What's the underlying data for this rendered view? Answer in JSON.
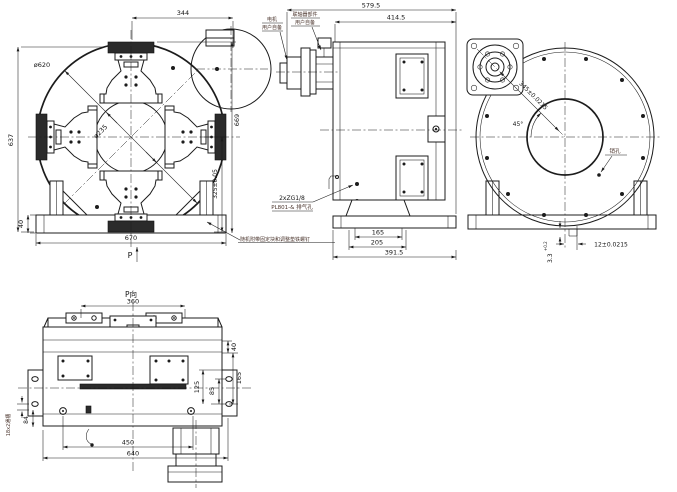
{
  "meta": {
    "background": "#ffffff",
    "line_color": "#1c1c1c",
    "annotation_color": "#4a342c"
  },
  "front": {
    "dim_motor_offset": "344",
    "dim_height": "637",
    "dia_outer": "ø620",
    "dia_inner": "ø235",
    "dim_center_height": "325±0.05",
    "dim_overall_height": "669",
    "dim_base_width": "670",
    "dim_base_height": "40",
    "view_arrow": "P",
    "note": "随机附带固定块和调整垫铁螺钉"
  },
  "side": {
    "dim_overall": "579.5",
    "dim_body": "414.5",
    "dim_base_inner": "165",
    "dim_base_mid": "205",
    "dim_base_outer": "391.5",
    "motor_label_1": "电机",
    "motor_label_2": "用户自备",
    "coupling_label_1": "联轴器部件",
    "coupling_label_2": "用户自备",
    "port_label_1": "2xZG1/8",
    "port_label_2": "PL801-& 排气孔"
  },
  "rear": {
    "dim_diagonal": "345±0.0215",
    "angle": "45°",
    "dim_offset": "12±0.0215",
    "dim_gap": "3.3",
    "dim_gap_tol": "+0.2",
    "pin_label": "销孔"
  },
  "bottom": {
    "view_title": "P向",
    "dim_top": "360",
    "dim_right_1": "40",
    "dim_right_2": "125",
    "dim_right_3": "85",
    "dim_right_4": "165",
    "dim_bottom_1": "450",
    "dim_bottom_2": "640",
    "slot_label": "18x2通槽",
    "dim_left": "84"
  }
}
